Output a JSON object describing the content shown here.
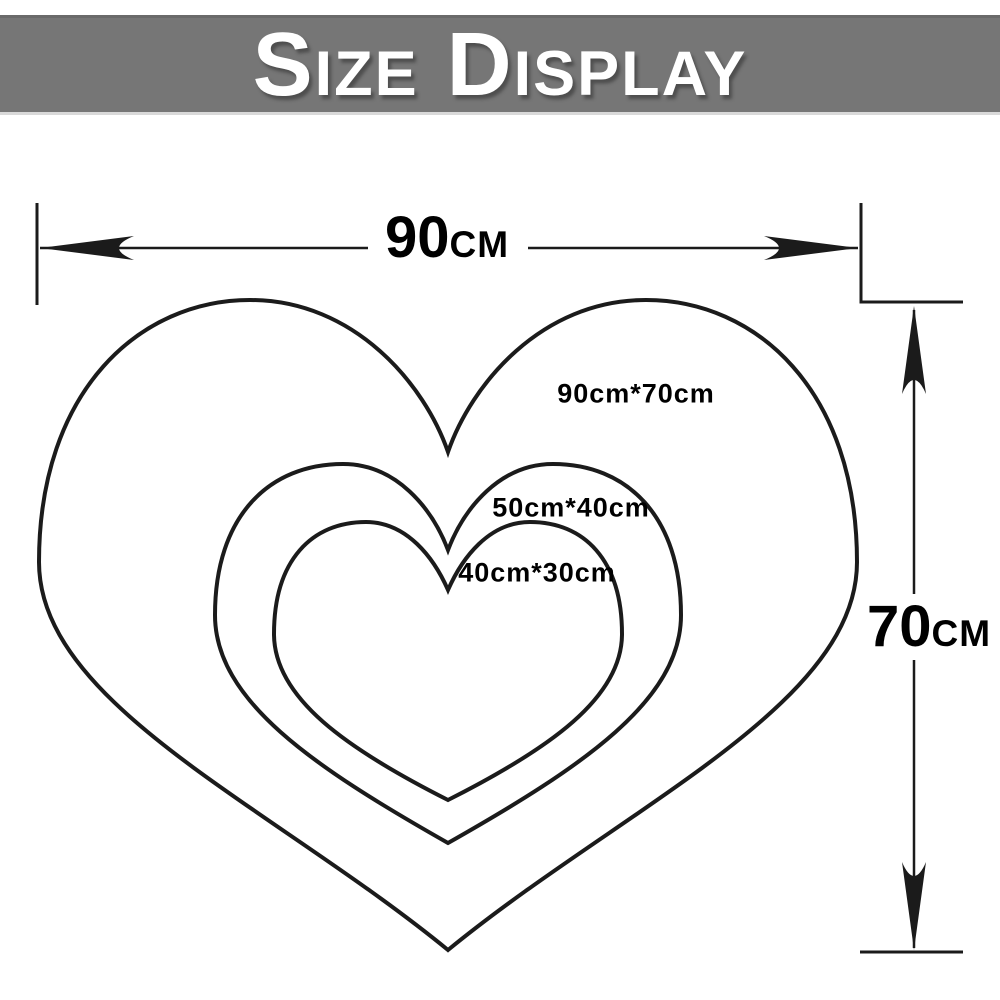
{
  "banner": {
    "title": "Size Display",
    "title_parts": {
      "initial_1": "S",
      "rest_1": "IZE",
      "initial_2": "D",
      "rest_2": "ISPLAY"
    },
    "bg_color": "#767676",
    "text_color": "#ffffff"
  },
  "dimensions": {
    "width": {
      "value": "90",
      "unit": "CM"
    },
    "height": {
      "value": "70",
      "unit": "CM"
    }
  },
  "hearts": [
    {
      "name": "large",
      "label": "90cm*70cm"
    },
    {
      "name": "medium",
      "label": "50cm*40cm"
    },
    {
      "name": "small",
      "label": "40cm*30cm"
    }
  ],
  "colors": {
    "outline": "#1b1b1b",
    "label_text": "#000000"
  }
}
